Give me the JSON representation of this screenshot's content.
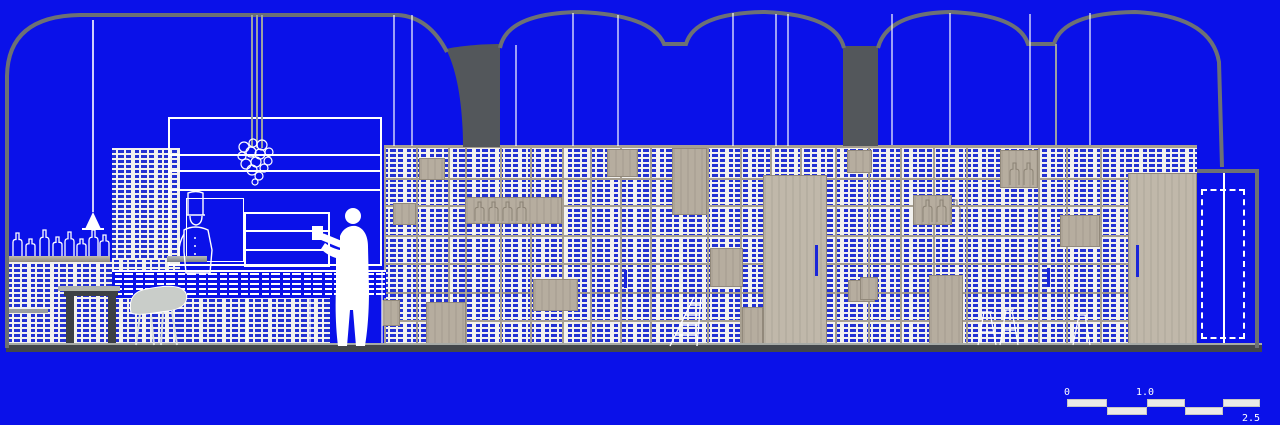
{
  "colors": {
    "bg": "#0a11e9",
    "dash": "#2331d2",
    "panel": "#f2f1ee",
    "tan": "#a79f91",
    "wood": "#b6ad9f",
    "woodDark": "#92897b",
    "woodLight": "#c0b8aa",
    "gray": "#6d7175",
    "darkGray": "#53575b",
    "rod": "#9aa0a4",
    "floorDark": "#42464a",
    "floorLight": "#a6aaa6",
    "handle": "#1a26d8",
    "chairFill": "#c9cdc9",
    "etch": "#8b8274",
    "white": "#ffffff"
  },
  "scalebar": {
    "labels": [
      "0",
      "1.0",
      "2.5"
    ],
    "segments": [
      {
        "x": 1067,
        "y": 399,
        "w": 40
      },
      {
        "x": 1107,
        "y": 407,
        "w": 40
      },
      {
        "x": 1147,
        "y": 399,
        "w": 38
      },
      {
        "x": 1185,
        "y": 407,
        "w": 38
      },
      {
        "x": 1223,
        "y": 399,
        "w": 37
      }
    ]
  },
  "wall": {
    "x": 384,
    "y": 145,
    "w": 813,
    "h": 202,
    "cols": [
      416,
      448,
      465,
      500,
      530,
      562,
      590,
      620,
      650,
      707,
      740,
      770,
      800,
      835,
      868,
      900,
      933,
      966,
      1038,
      1066,
      1100
    ],
    "rows": [
      178,
      205,
      235,
      263,
      292,
      320
    ]
  },
  "wood_panels": [
    {
      "x": 419,
      "y": 158,
      "w": 26,
      "h": 22
    },
    {
      "x": 393,
      "y": 203,
      "w": 23,
      "h": 22
    },
    {
      "x": 465,
      "y": 197,
      "w": 97,
      "h": 27,
      "etch": 4
    },
    {
      "x": 426,
      "y": 302,
      "w": 40,
      "h": 42
    },
    {
      "x": 382,
      "y": 300,
      "w": 18,
      "h": 26
    },
    {
      "x": 533,
      "y": 279,
      "w": 45,
      "h": 32
    },
    {
      "x": 607,
      "y": 149,
      "w": 31,
      "h": 28
    },
    {
      "x": 672,
      "y": 148,
      "w": 35,
      "h": 67
    },
    {
      "x": 710,
      "y": 248,
      "w": 33,
      "h": 39
    },
    {
      "x": 742,
      "y": 307,
      "w": 21,
      "h": 38
    },
    {
      "x": 847,
      "y": 150,
      "w": 25,
      "h": 23
    },
    {
      "x": 848,
      "y": 280,
      "w": 27,
      "h": 22
    },
    {
      "x": 913,
      "y": 195,
      "w": 39,
      "h": 30,
      "etch": 3
    },
    {
      "x": 1000,
      "y": 150,
      "w": 38,
      "h": 38,
      "etch": 2
    },
    {
      "x": 1060,
      "y": 215,
      "w": 40,
      "h": 32
    },
    {
      "x": 929,
      "y": 275,
      "w": 34,
      "h": 70
    },
    {
      "x": 860,
      "y": 277,
      "w": 18,
      "h": 23
    },
    {
      "x": 763,
      "y": 175,
      "w": 64,
      "h": 171,
      "light": true
    },
    {
      "x": 1128,
      "y": 173,
      "w": 69,
      "h": 173,
      "light": true
    }
  ],
  "handles": [
    {
      "x": 815,
      "y": 245,
      "h": 31
    },
    {
      "x": 1136,
      "y": 245,
      "h": 32
    },
    {
      "x": 624,
      "y": 270,
      "h": 18
    },
    {
      "x": 1047,
      "y": 268,
      "h": 19
    }
  ],
  "wires": [
    {
      "x": 93,
      "y1": 20,
      "y2": 212,
      "c": "w"
    },
    {
      "x": 252,
      "y1": 15,
      "y2": 148,
      "c": "g"
    },
    {
      "x": 257,
      "y1": 15,
      "y2": 148,
      "c": "g"
    },
    {
      "x": 262,
      "y1": 15,
      "y2": 148,
      "c": "g"
    },
    {
      "x": 394,
      "y1": 15,
      "y2": 146,
      "c": "w"
    },
    {
      "x": 412,
      "y1": 15,
      "y2": 146,
      "c": "w"
    },
    {
      "x": 516,
      "y1": 45,
      "y2": 146,
      "c": "w"
    },
    {
      "x": 573,
      "y1": 13,
      "y2": 146,
      "c": "w"
    },
    {
      "x": 618,
      "y1": 15,
      "y2": 146,
      "c": "w"
    },
    {
      "x": 733,
      "y1": 13,
      "y2": 146,
      "c": "w"
    },
    {
      "x": 776,
      "y1": 14,
      "y2": 146,
      "c": "w"
    },
    {
      "x": 788,
      "y1": 14,
      "y2": 146,
      "c": "w"
    },
    {
      "x": 892,
      "y1": 14,
      "y2": 145,
      "c": "w"
    },
    {
      "x": 950,
      "y1": 13,
      "y2": 145,
      "c": "w"
    },
    {
      "x": 1030,
      "y1": 14,
      "y2": 145,
      "c": "w"
    },
    {
      "x": 1056,
      "y1": 44,
      "y2": 145,
      "c": "g"
    },
    {
      "x": 1090,
      "y1": 13,
      "y2": 145,
      "c": "w"
    }
  ],
  "bottles": {
    "baseline": 256,
    "items": [
      {
        "x": 13,
        "h": 23
      },
      {
        "x": 26,
        "h": 17
      },
      {
        "x": 40,
        "h": 26
      },
      {
        "x": 53,
        "h": 19
      },
      {
        "x": 65,
        "h": 24
      },
      {
        "x": 77,
        "h": 17
      },
      {
        "x": 89,
        "h": 26
      },
      {
        "x": 100,
        "h": 21
      }
    ]
  },
  "chandelier": {
    "cx": 256,
    "cy": 155,
    "orbs": [
      [
        -12,
        -8,
        5
      ],
      [
        -3,
        -12,
        4
      ],
      [
        6,
        -10,
        5
      ],
      [
        13,
        -3,
        4
      ],
      [
        -14,
        1,
        4
      ],
      [
        -5,
        -3,
        5
      ],
      [
        4,
        -1,
        5
      ],
      [
        12,
        6,
        4
      ],
      [
        -10,
        9,
        5
      ],
      [
        0,
        7,
        5
      ],
      [
        8,
        13,
        4
      ],
      [
        -4,
        15,
        5
      ],
      [
        3,
        21,
        4
      ],
      [
        -1,
        27,
        3
      ]
    ]
  }
}
